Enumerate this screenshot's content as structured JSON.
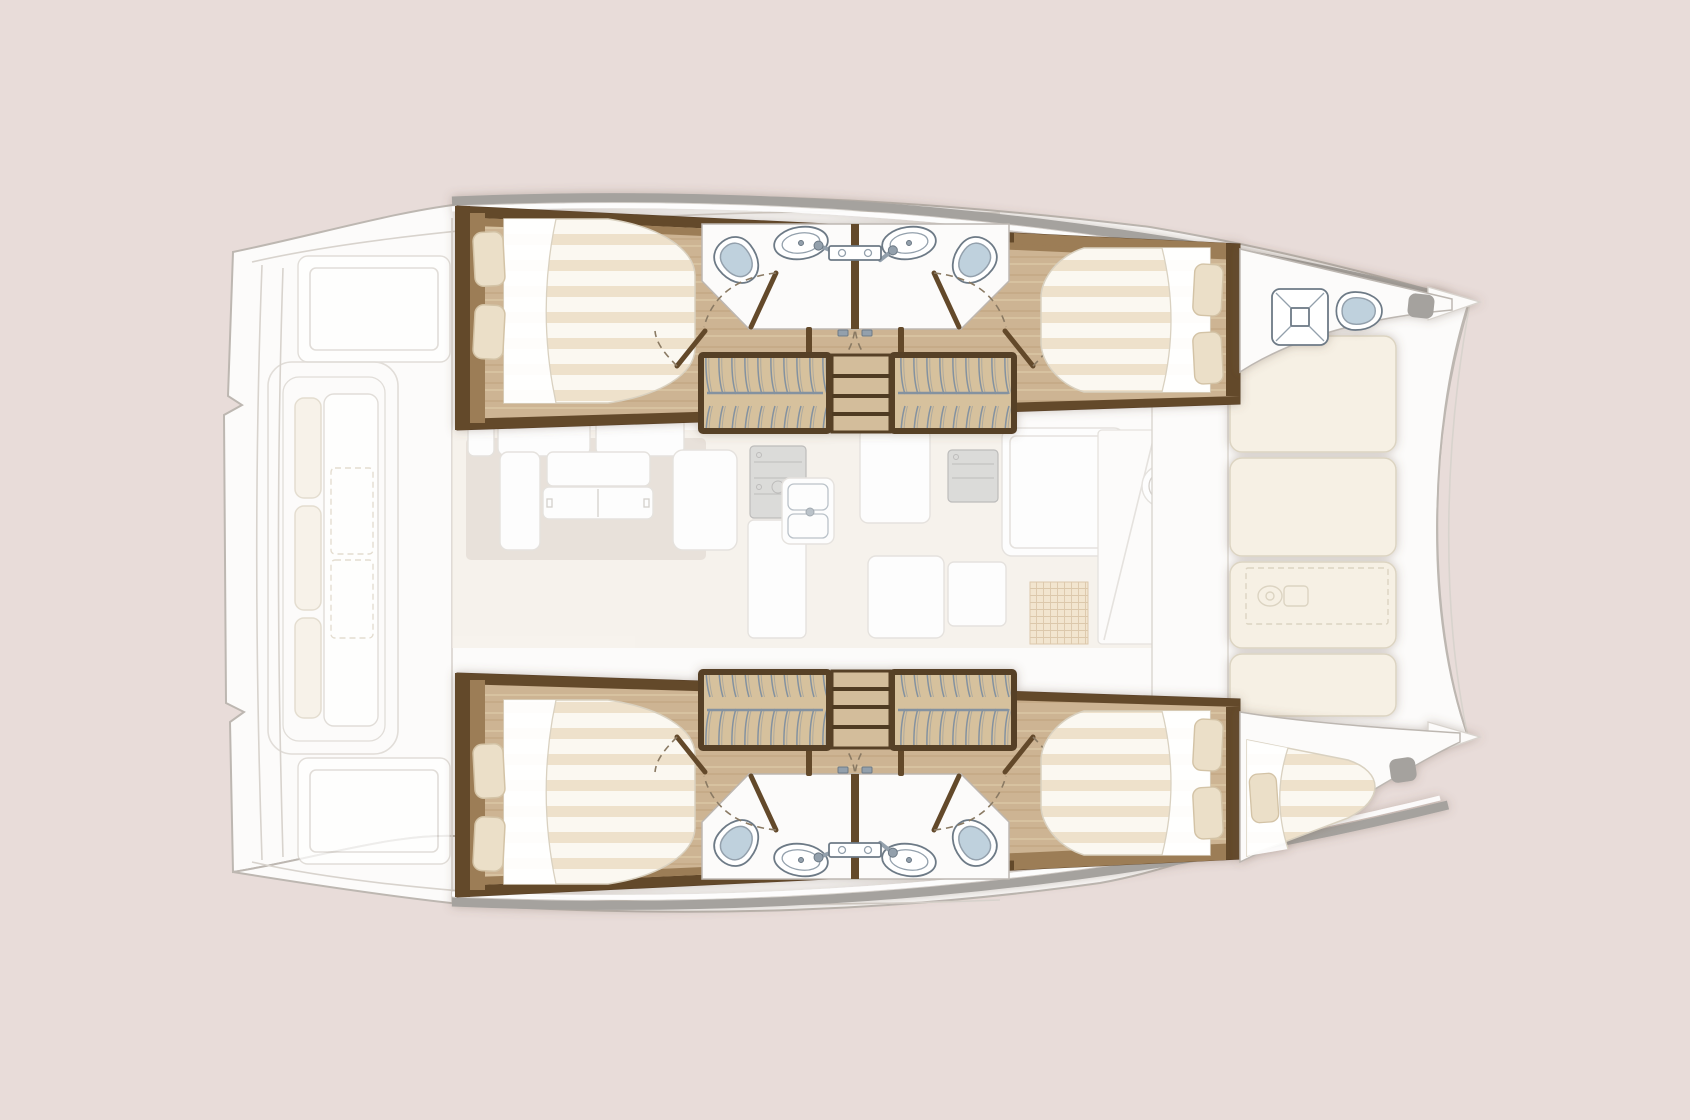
{
  "meta": {
    "type": "boat-floor-plan",
    "subject": "catamaran interior layout plan, top-down view",
    "bow_direction": "right",
    "stern_direction": "left",
    "visible_text": "none"
  },
  "palette": {
    "bg": "#e8dcd9",
    "deck": "#fcfbfa",
    "deckLine": "#bdb7b1",
    "deckLineSoft": "#d8d3cd",
    "white": "#ffffff",
    "cream": "#f6f0e4",
    "creamLine": "#dcd4c2",
    "saloonFloor": "#f3ede5",
    "rug": "#d6cbbf",
    "wood": "#cdb493",
    "woodGrainDark": "#bca079",
    "woodGrainLight": "#dcc8a6",
    "woodDark": "#64492c",
    "woodMid": "#9c7d56",
    "woodFrame": "#573f27",
    "wardrobe": "#d6c19d",
    "hangerWire": "#8492a0",
    "stepWood": "#d3bd9b",
    "stepLine": "#4f3a24",
    "mattressBase": "#fbf8f1",
    "mattressStripe": "#eee1cb",
    "mattressLine": "#d9d1c0",
    "pillow": "#ebdfc8",
    "pillowLine": "#d3c3a6",
    "toiletBowl": "#bfd1dd",
    "fixtureLine": "#6d7a86",
    "fixtureMid": "#93a0ac",
    "gunwale": "#a5a29e",
    "doorArc": "#8a7a64",
    "appliance": "#c8c8c6",
    "applianceLine": "#979795",
    "matGrid": "#ecd8b6",
    "matGridLine": "#c9a97b",
    "shadow": "#6e5c49"
  },
  "layout": {
    "areas": [
      {
        "name": "aft-cockpit",
        "rendering": "faded",
        "features": [
          "swim-platform",
          "transom-steps",
          "cockpit-bench-sofa",
          "deck-hatch-panels"
        ]
      },
      {
        "name": "saloon-nacelle",
        "rendering": "faded",
        "features": [
          "sofa-cushions",
          "coffee-table",
          "bench-seat",
          "galley-stove",
          "galley-double-sink",
          "oven-appliance",
          "refrigerator",
          "counters",
          "entry-grid-mat",
          "round-basin",
          "sliding-door-to-foredeck"
        ]
      },
      {
        "name": "foredeck",
        "rendering": "solid",
        "features": [
          "sunpad-row-1",
          "sunpad-row-2",
          "sunpad-row-3",
          "sunpad-row-4",
          "windlass-locker-dashed-outline",
          "forestay-bridle-lines"
        ]
      },
      {
        "name": "port-hull-top",
        "rendering": "solid",
        "rooms": [
          {
            "name": "aft-cabin",
            "features": [
              "double-berth",
              "pillow-x2",
              "folded-sheet",
              "door-with-swing-arc"
            ]
          },
          {
            "name": "bathroom-aft",
            "features": [
              "toilet",
              "washbasin",
              "vanity-shelf",
              "door-with-swing-arc"
            ]
          },
          {
            "name": "bathroom-forward",
            "features": [
              "toilet",
              "washbasin",
              "vanity-shelf",
              "door-with-swing-arc"
            ]
          },
          {
            "name": "companionway",
            "features": [
              "stairs-3-treads",
              "double-doors-with-arcs",
              "hanging-wardrobe-aft",
              "hanging-wardrobe-forward"
            ]
          },
          {
            "name": "forward-cabin",
            "features": [
              "double-berth",
              "pillow-x2",
              "folded-sheet",
              "door-with-swing-arc"
            ]
          },
          {
            "name": "forepeak",
            "features": [
              "deck-hatch",
              "marine-toilet",
              "bow-locker"
            ]
          }
        ]
      },
      {
        "name": "starboard-hull-bottom",
        "rendering": "solid",
        "rooms": [
          {
            "name": "aft-cabin",
            "features": [
              "double-berth",
              "pillow-x2",
              "folded-sheet",
              "door-with-swing-arc"
            ]
          },
          {
            "name": "bathroom-aft",
            "features": [
              "toilet",
              "washbasin",
              "vanity-shelf",
              "door-with-swing-arc"
            ]
          },
          {
            "name": "bathroom-forward",
            "features": [
              "toilet",
              "washbasin",
              "vanity-shelf",
              "door-with-swing-arc"
            ]
          },
          {
            "name": "companionway",
            "features": [
              "stairs-3-treads",
              "double-doors-with-arcs",
              "hanging-wardrobe-aft",
              "hanging-wardrobe-forward"
            ]
          },
          {
            "name": "forward-cabin",
            "features": [
              "double-berth",
              "pillow-x2",
              "folded-sheet",
              "door-with-swing-arc"
            ]
          },
          {
            "name": "forepeak",
            "features": [
              "single-bow-berth",
              "pillow",
              "bow-locker"
            ]
          }
        ]
      }
    ],
    "counts": {
      "double_berths": 4,
      "bow_berths": 1,
      "bathrooms": 4,
      "toilets": 5,
      "washbasins": 4,
      "hanging_wardrobes": 4,
      "stair_flights": 2,
      "sunpad_cushions": 4
    }
  }
}
